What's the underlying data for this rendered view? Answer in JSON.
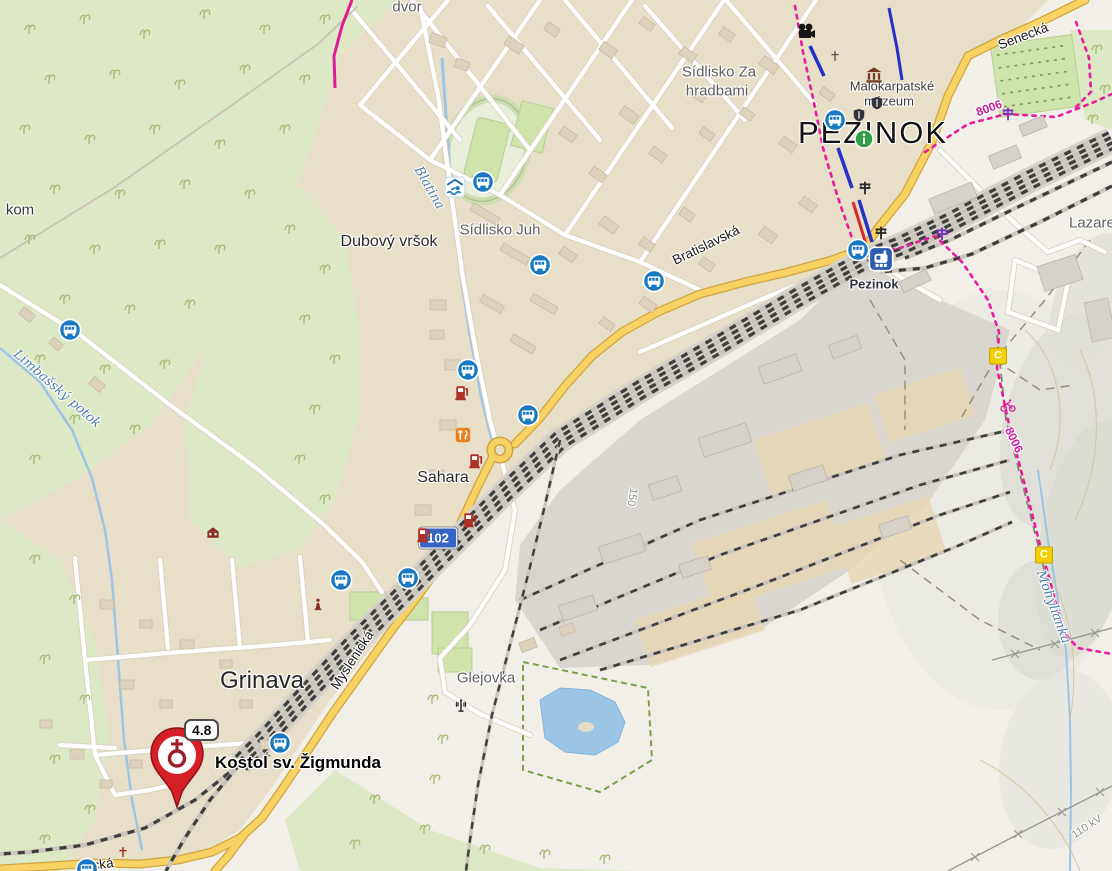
{
  "labels": {
    "pezinok": "PEZINOK",
    "sidlisko_za_hradbami_line1": "Sídlisko Za",
    "sidlisko_za_hradbami_line2": "hradbami",
    "muzeum_line1": "Malokarpatské",
    "muzeum_line2": "múzeum",
    "station_pezinok": "Pezinok",
    "senecka": "Senecká",
    "bratislavska": "Bratislavská",
    "myslenicka": "Myslenická",
    "dubovy_vrsok": "Dubový vršok",
    "sidlisko_juh": "Sídlisko Juh",
    "sahara": "Sahara",
    "grinava": "Grinava",
    "glejovka": "Glejovka",
    "blatina": "Blatina",
    "limbassky_potok": "Limbašský potok",
    "mohylianka": "Mohylianka",
    "route_8006_a": "8006",
    "route_8006_b": "8006",
    "power_110kv": "110 kV",
    "contour_150": "150",
    "dvor_partial": "dvor",
    "kom_partial": "kom",
    "lazaret_partial": "Lazaret",
    "cka_partial": "cká"
  },
  "marker": {
    "title": "Kostol sv. Žigmunda",
    "rating": "4.8"
  },
  "road_shield": {
    "number": "102"
  },
  "cycle_route_badges": {
    "c": "C"
  },
  "icons": [
    {
      "name": "bus-stop-icon",
      "x": 70,
      "y": 330
    },
    {
      "name": "bus-stop-icon",
      "x": 483,
      "y": 182
    },
    {
      "name": "bus-stop-icon",
      "x": 540,
      "y": 265
    },
    {
      "name": "bus-stop-icon",
      "x": 654,
      "y": 281
    },
    {
      "name": "bus-stop-icon",
      "x": 468,
      "y": 370
    },
    {
      "name": "bus-stop-icon",
      "x": 528,
      "y": 415
    },
    {
      "name": "bus-stop-icon",
      "x": 341,
      "y": 580
    },
    {
      "name": "bus-stop-icon",
      "x": 408,
      "y": 578
    },
    {
      "name": "bus-stop-icon",
      "x": 280,
      "y": 743
    },
    {
      "name": "bus-stop-icon",
      "x": 835,
      "y": 120
    },
    {
      "name": "bus-stop-icon",
      "x": 858,
      "y": 250
    },
    {
      "name": "bus-stop-icon",
      "x": 87,
      "y": 869
    },
    {
      "name": "train-station-icon",
      "x": 881,
      "y": 259
    },
    {
      "name": "swimming-pool-icon",
      "x": 455,
      "y": 187
    },
    {
      "name": "tourist-info-icon",
      "x": 864,
      "y": 139
    },
    {
      "name": "cinema-icon",
      "x": 806,
      "y": 31
    },
    {
      "name": "museum-icon",
      "x": 874,
      "y": 75
    },
    {
      "name": "level-crossing-icon",
      "x": 865,
      "y": 188,
      "color": "#262626"
    },
    {
      "name": "level-crossing-icon",
      "x": 881,
      "y": 233,
      "color": "#262626"
    },
    {
      "name": "level-crossing-icon",
      "x": 1008,
      "y": 114,
      "color": "#7b2fc6"
    },
    {
      "name": "level-crossing-icon",
      "x": 942,
      "y": 234,
      "color": "#7b2fc6"
    },
    {
      "name": "fuel-station-icon",
      "x": 462,
      "y": 392
    },
    {
      "name": "fuel-station-icon",
      "x": 476,
      "y": 460
    },
    {
      "name": "fuel-station-icon",
      "x": 470,
      "y": 519
    },
    {
      "name": "fuel-station-icon",
      "x": 424,
      "y": 534
    },
    {
      "name": "restaurant-icon",
      "x": 463,
      "y": 435
    },
    {
      "name": "wayside-cross-icon",
      "x": 835,
      "y": 56,
      "color": "#5f564c"
    },
    {
      "name": "wayside-cross-icon",
      "x": 123,
      "y": 852,
      "color": "#9c2b20"
    },
    {
      "name": "wayside-cross-icon",
      "x": 267,
      "y": 757,
      "color": "#6e6e6e"
    },
    {
      "name": "statue-icon",
      "x": 318,
      "y": 604
    },
    {
      "name": "manor-icon",
      "x": 213,
      "y": 533
    },
    {
      "name": "castle-icon",
      "x": 877,
      "y": 103
    },
    {
      "name": "castle-icon",
      "x": 859,
      "y": 115
    },
    {
      "name": "antenna-icon",
      "x": 461,
      "y": 706
    },
    {
      "name": "cycling-icon",
      "x": 1008,
      "y": 406
    }
  ],
  "colors": {
    "primary_road": "#f8d263",
    "water": "#9cc4e4",
    "forest": "#dde9c4",
    "urban": "#e8dfc9",
    "industrial": "#d9d6cf",
    "cycle_route": "#ea1c9e",
    "bus_icon": "#1878c2",
    "marker_red": "#d5202a",
    "shield_102_bg": "#3566c4"
  }
}
